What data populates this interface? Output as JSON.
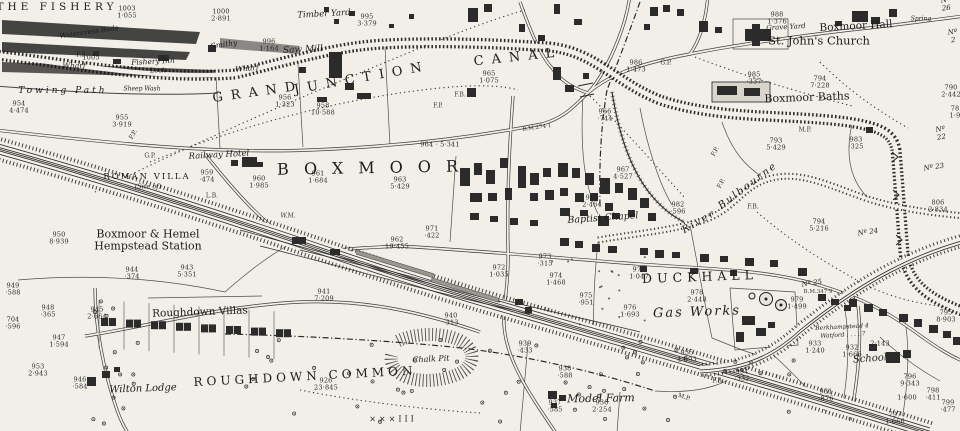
{
  "map": {
    "region_name": "Boxmoor and Roughdown Common (historic Ordnance Survey style plan)",
    "paper_color": "#f2efe8",
    "ink_color": "#1c1c1c",
    "labels": [
      {
        "id": "label-the-fishery",
        "t": "THE FISHERY",
        "x": 57,
        "y": 8,
        "fs": 10.5,
        "ls": 4,
        "cls": "big"
      },
      {
        "id": "label-grand",
        "t": "GRAND",
        "x": 258,
        "y": 93,
        "fs": 13,
        "ls": 8,
        "rot": -8,
        "cls": "big"
      },
      {
        "id": "label-junction",
        "t": "JUNCTION",
        "x": 362,
        "y": 79,
        "fs": 13,
        "ls": 8,
        "rot": -10,
        "cls": "big"
      },
      {
        "id": "label-canal",
        "t": "CANAL",
        "x": 518,
        "y": 58,
        "fs": 13,
        "ls": 8,
        "rot": -6,
        "cls": "big"
      },
      {
        "id": "label-boxmoor",
        "t": "BOXMOOR",
        "x": 375,
        "y": 168,
        "fs": 16,
        "ls": 15,
        "rot": -1,
        "cls": "big"
      },
      {
        "id": "label-roughdown-common",
        "t": "ROUGHDOWN COMMON",
        "x": 305,
        "y": 377,
        "fs": 12,
        "ls": 4,
        "rot": -3,
        "cls": "big"
      },
      {
        "id": "label-duckhall",
        "t": "DUCKHALL",
        "x": 700,
        "y": 277,
        "fs": 12.5,
        "ls": 5,
        "rot": -2,
        "cls": "big"
      },
      {
        "id": "label-gas-works",
        "t": "Gas Works",
        "x": 697,
        "y": 313,
        "fs": 13,
        "ls": 2,
        "rot": -2,
        "cls": "it"
      },
      {
        "id": "label-station",
        "t": "Boxmoor & Hemel\nHempstead Station",
        "x": 148,
        "y": 241,
        "fs": 11
      },
      {
        "id": "label-roughdown-villas",
        "t": "Roughdown Villas",
        "x": 200,
        "y": 313,
        "fs": 10.5,
        "rot": -2
      },
      {
        "id": "label-wilton-lodge",
        "t": "Wilton Lodge",
        "x": 143,
        "y": 389,
        "fs": 10,
        "rot": -2,
        "cls": "it"
      },
      {
        "id": "label-chalk-pit",
        "t": "Chalk Pit",
        "x": 431,
        "y": 360,
        "fs": 8,
        "rot": -3,
        "cls": "it"
      },
      {
        "id": "label-model-farm",
        "t": "Model Farm",
        "x": 601,
        "y": 399,
        "fs": 11,
        "rot": -1,
        "cls": "it"
      },
      {
        "id": "label-st-johns-church",
        "t": "St. John's Church",
        "x": 819,
        "y": 41,
        "fs": 11.5
      },
      {
        "id": "label-boxmoor-hall",
        "t": "Boxmoor Hall",
        "x": 856,
        "y": 27,
        "fs": 10.5,
        "rot": -3
      },
      {
        "id": "label-grave-yard",
        "t": "Grave Yard",
        "x": 786,
        "y": 28,
        "fs": 7,
        "rot": -3,
        "cls": "it"
      },
      {
        "id": "label-boxmoor-baths",
        "t": "Boxmoor Baths",
        "x": 807,
        "y": 98,
        "fs": 11,
        "rot": -2
      },
      {
        "id": "label-railway-hotel",
        "t": "Railway Hotel",
        "x": 219,
        "y": 156,
        "fs": 8.5,
        "rot": -3,
        "cls": "it"
      },
      {
        "id": "label-roman-villa",
        "t": "ROMAN VILLA",
        "x": 147,
        "y": 178,
        "fs": 8.5,
        "ls": 2,
        "cls": "big"
      },
      {
        "id": "label-roman-villa-site",
        "t": "(Site of)",
        "x": 148,
        "y": 187,
        "fs": 6.5,
        "cls": "it"
      },
      {
        "id": "label-baptist-chapel",
        "t": "Baptist Chapel",
        "x": 603,
        "y": 219,
        "fs": 9.5,
        "rot": -4,
        "cls": "it"
      },
      {
        "id": "label-river",
        "t": "River",
        "x": 699,
        "y": 222,
        "fs": 10,
        "ls": 2,
        "rot": -30,
        "cls": "it"
      },
      {
        "id": "label-bulbourne",
        "t": "Bulbourne",
        "x": 748,
        "y": 186,
        "fs": 10,
        "ls": 2,
        "rot": -37,
        "cls": "it"
      },
      {
        "id": "label-towing-path",
        "t": "Towing Path",
        "x": 63,
        "y": 91,
        "fs": 9,
        "ls": 3,
        "cls": "it"
      },
      {
        "id": "label-wharf-1",
        "t": "Wharf",
        "x": 74,
        "y": 66,
        "fs": 7.5,
        "cls": "it"
      },
      {
        "id": "label-wharf-2",
        "t": "Wharf",
        "x": 247,
        "y": 69,
        "fs": 7.5,
        "rot": -5,
        "cls": "it"
      },
      {
        "id": "label-saw-mill",
        "t": "Saw Mill",
        "x": 303,
        "y": 50,
        "fs": 9,
        "rot": -3,
        "cls": "it"
      },
      {
        "id": "label-timber-yard",
        "t": "Timber Yard",
        "x": 324,
        "y": 15,
        "fs": 8.5,
        "rot": -3,
        "cls": "it"
      },
      {
        "id": "label-smithy",
        "t": "Smithy",
        "x": 224,
        "y": 45,
        "fs": 7.5,
        "rot": -8,
        "cls": "it"
      },
      {
        "id": "label-fishery-inn",
        "t": "Fishery Inn",
        "x": 153,
        "y": 62,
        "fs": 7.5,
        "rot": -3,
        "cls": "it"
      },
      {
        "id": "label-lock",
        "t": "Lock",
        "x": 158,
        "y": 71,
        "fs": 6.5,
        "cls": "it"
      },
      {
        "id": "label-watercress-beds",
        "t": "Watercress Beds",
        "x": 89,
        "y": 33,
        "fs": 7,
        "rot": -8,
        "cls": "it"
      },
      {
        "id": "label-sheep-wash",
        "t": "Sheep Wash",
        "x": 142,
        "y": 90,
        "fs": 6,
        "cls": "it"
      },
      {
        "id": "label-school",
        "t": "School",
        "x": 870,
        "y": 359,
        "fs": 10,
        "rot": -4,
        "cls": "it"
      },
      {
        "id": "label-spring",
        "t": "Spring",
        "x": 921,
        "y": 20,
        "fs": 6,
        "cls": "it"
      },
      {
        "id": "label-berkhamsted",
        "t": "Berkhampstead 4",
        "x": 842,
        "y": 328,
        "fs": 6,
        "rot": -3,
        "cls": "it"
      },
      {
        "id": "label-watford",
        "t": "Watford . . . . 7",
        "x": 843,
        "y": 336,
        "fs": 6,
        "rot": -3,
        "cls": "it"
      },
      {
        "id": "label-xxx-marks",
        "t": "×××III",
        "x": 393,
        "y": 420,
        "fs": 8,
        "ls": 3
      },
      {
        "id": "label-wm",
        "t": "W.M.",
        "x": 288,
        "y": 217,
        "fs": 6,
        "cls": "abbr it"
      },
      {
        "id": "label-lb",
        "t": "L.B.",
        "x": 212,
        "y": 197,
        "fs": 6,
        "cls": "abbr"
      },
      {
        "id": "label-gp-1",
        "t": "G.P.",
        "x": 150,
        "y": 157,
        "fs": 6,
        "cls": "abbr"
      },
      {
        "id": "label-gp-2",
        "t": "G.P.",
        "x": 666,
        "y": 64,
        "fs": 6,
        "cls": "abbr"
      },
      {
        "id": "label-fp-1",
        "t": "F.P.",
        "x": 438,
        "y": 107,
        "fs": 6,
        "cls": "abbr"
      },
      {
        "id": "label-fp-2",
        "t": "F.P.",
        "x": 716,
        "y": 152,
        "fs": 6,
        "rot": -60,
        "cls": "abbr"
      },
      {
        "id": "label-fp-3",
        "t": "F.P.",
        "x": 722,
        "y": 184,
        "fs": 6,
        "rot": -60,
        "cls": "abbr"
      },
      {
        "id": "label-fp-4",
        "t": "F.P.",
        "x": 134,
        "y": 135,
        "fs": 6,
        "rot": -60,
        "cls": "abbr"
      },
      {
        "id": "label-fb-1",
        "t": "F.B.",
        "x": 82,
        "y": 56,
        "fs": 6,
        "cls": "abbr"
      },
      {
        "id": "label-fb-2",
        "t": "F.B.",
        "x": 460,
        "y": 96,
        "fs": 6,
        "cls": "abbr"
      },
      {
        "id": "label-fb-3",
        "t": "F.B.",
        "x": 753,
        "y": 208,
        "fs": 6,
        "cls": "abbr"
      },
      {
        "id": "label-fb-4",
        "t": "F.B.",
        "x": 718,
        "y": 382,
        "fs": 6,
        "cls": "abbr"
      },
      {
        "id": "label-mp-1",
        "t": "M.P.",
        "x": 805,
        "y": 131,
        "fs": 6,
        "cls": "abbr"
      },
      {
        "id": "label-mp-2",
        "t": "M.P.",
        "x": 684,
        "y": 398,
        "fs": 6,
        "rot": 17,
        "cls": "abbr"
      },
      {
        "id": "label-bm-1",
        "t": "B.M.274·1",
        "x": 537,
        "y": 128,
        "fs": 5.5,
        "rot": -8,
        "cls": "abbr"
      },
      {
        "id": "label-bm-2",
        "t": "B.M.347·9",
        "x": 818,
        "y": 292,
        "fs": 5.5,
        "cls": "abbr"
      },
      {
        "id": "label-lock-no26",
        "t": "Nº 26",
        "x": 946,
        "y": 5,
        "fs": 7,
        "rot": -6,
        "cls": "it"
      },
      {
        "id": "label-lock-no21",
        "t": "Nº 2",
        "x": 953,
        "y": 37,
        "fs": 7,
        "rot": -6,
        "cls": "it"
      },
      {
        "id": "label-lock-no22",
        "t": "Nº 22",
        "x": 941,
        "y": 134,
        "fs": 7,
        "rot": -8,
        "cls": "it"
      },
      {
        "id": "label-lock-no23",
        "t": "Nº 23",
        "x": 934,
        "y": 168,
        "fs": 7,
        "rot": -8,
        "cls": "it"
      },
      {
        "id": "label-lock-no24",
        "t": "Nº 24",
        "x": 868,
        "y": 233,
        "fs": 7,
        "rot": -8,
        "cls": "it"
      },
      {
        "id": "label-lock-no25",
        "t": "Nº 25",
        "x": 812,
        "y": 284,
        "fs": 7,
        "rot": -8,
        "cls": "it"
      },
      {
        "id": "parcel-1003",
        "t": "1003\n1·055",
        "x": 127,
        "y": 13,
        "cls": "parcel"
      },
      {
        "id": "parcel-1000",
        "t": "1000\n2·891",
        "x": 221,
        "y": 16,
        "cls": "parcel"
      },
      {
        "id": "parcel-1005",
        "t": "1005",
        "x": 91,
        "y": 58,
        "cls": "parcel"
      },
      {
        "id": "parcel-996",
        "t": "996\n1·164",
        "x": 269,
        "y": 46,
        "cls": "parcel"
      },
      {
        "id": "parcel-995",
        "t": "995\n3·379",
        "x": 367,
        "y": 21,
        "cls": "parcel"
      },
      {
        "id": "parcel-955",
        "t": "955\n3·919",
        "x": 122,
        "y": 122,
        "cls": "parcel"
      },
      {
        "id": "parcel-954",
        "t": "954\n4·474",
        "x": 19,
        "y": 108,
        "cls": "parcel"
      },
      {
        "id": "parcel-956",
        "t": "956\n1·323",
        "x": 285,
        "y": 102,
        "cls": "parcel"
      },
      {
        "id": "parcel-958",
        "t": "958\n10·588",
        "x": 323,
        "y": 110,
        "cls": "parcel"
      },
      {
        "id": "parcel-964",
        "t": "964 · 5·341",
        "x": 440,
        "y": 145,
        "cls": "parcel"
      },
      {
        "id": "parcel-959",
        "t": "959\n·474",
        "x": 207,
        "y": 177,
        "cls": "parcel"
      },
      {
        "id": "parcel-960",
        "t": "960\n1·985",
        "x": 259,
        "y": 183,
        "cls": "parcel"
      },
      {
        "id": "parcel-961",
        "t": "961\n1·684",
        "x": 318,
        "y": 178,
        "cls": "parcel"
      },
      {
        "id": "parcel-963",
        "t": "963\n5·429",
        "x": 400,
        "y": 184,
        "cls": "parcel"
      },
      {
        "id": "parcel-962",
        "t": "962\n19·455",
        "x": 397,
        "y": 244,
        "cls": "parcel"
      },
      {
        "id": "parcel-971",
        "t": "971\n·422",
        "x": 432,
        "y": 233,
        "cls": "parcel"
      },
      {
        "id": "parcel-972",
        "t": "972\n1·035",
        "x": 499,
        "y": 272,
        "cls": "parcel"
      },
      {
        "id": "parcel-973",
        "t": "973\n·315",
        "x": 545,
        "y": 261,
        "cls": "parcel"
      },
      {
        "id": "parcel-974",
        "t": "974\n1·468",
        "x": 556,
        "y": 280,
        "cls": "parcel"
      },
      {
        "id": "parcel-975",
        "t": "975\n·951",
        "x": 586,
        "y": 300,
        "cls": "parcel"
      },
      {
        "id": "parcel-976",
        "t": "976\n1·693",
        "x": 630,
        "y": 312,
        "cls": "parcel"
      },
      {
        "id": "parcel-977",
        "t": "977\n1·047",
        "x": 639,
        "y": 274,
        "cls": "parcel"
      },
      {
        "id": "parcel-978",
        "t": "978\n2·448",
        "x": 697,
        "y": 297,
        "cls": "parcel"
      },
      {
        "id": "parcel-979",
        "t": "979\n1·499",
        "x": 797,
        "y": 304,
        "cls": "parcel"
      },
      {
        "id": "parcel-982",
        "t": "982\n·596",
        "x": 678,
        "y": 209,
        "cls": "parcel"
      },
      {
        "id": "parcel-967",
        "t": "967\n4·527",
        "x": 623,
        "y": 174,
        "cls": "parcel"
      },
      {
        "id": "parcel-968",
        "t": "968\n2·464",
        "x": 592,
        "y": 202,
        "cls": "parcel"
      },
      {
        "id": "parcel-983",
        "t": "983\n·325",
        "x": 856,
        "y": 144,
        "cls": "parcel"
      },
      {
        "id": "parcel-793",
        "t": "793\n5·429",
        "x": 776,
        "y": 145,
        "cls": "parcel"
      },
      {
        "id": "parcel-794a",
        "t": "794\n7·228",
        "x": 820,
        "y": 83,
        "cls": "parcel"
      },
      {
        "id": "parcel-794b",
        "t": "794\n5·216",
        "x": 819,
        "y": 226,
        "cls": "parcel"
      },
      {
        "id": "parcel-795",
        "t": "795\n8·903",
        "x": 946,
        "y": 317,
        "cls": "parcel"
      },
      {
        "id": "parcel-796",
        "t": "796\n9·343",
        "x": 910,
        "y": 381,
        "cls": "parcel"
      },
      {
        "id": "parcel-1600",
        "t": "1·600",
        "x": 907,
        "y": 398,
        "cls": "parcel"
      },
      {
        "id": "parcel-798",
        "t": "798\n·411",
        "x": 933,
        "y": 395,
        "cls": "parcel"
      },
      {
        "id": "parcel-799",
        "t": "799\n·477",
        "x": 948,
        "y": 407,
        "cls": "parcel"
      },
      {
        "id": "parcel-797",
        "t": "797\n1·666",
        "x": 895,
        "y": 419,
        "cls": "parcel"
      },
      {
        "id": "parcel-790",
        "t": "790\n2·442",
        "x": 951,
        "y": 92,
        "cls": "parcel"
      },
      {
        "id": "parcel-78x",
        "t": "78\n1·9",
        "x": 955,
        "y": 113,
        "cls": "parcel"
      },
      {
        "id": "parcel-806",
        "t": "806\n2·834",
        "x": 938,
        "y": 207,
        "cls": "parcel"
      },
      {
        "id": "parcel-935",
        "t": "935\n4·693",
        "x": 687,
        "y": 357,
        "cls": "parcel"
      },
      {
        "id": "parcel-934",
        "t": "934\n·332",
        "x": 742,
        "y": 376,
        "cls": "parcel"
      },
      {
        "id": "parcel-933",
        "t": "933\n1·240",
        "x": 815,
        "y": 348,
        "cls": "parcel"
      },
      {
        "id": "parcel-932",
        "t": "932\n1·666",
        "x": 852,
        "y": 352,
        "cls": "parcel"
      },
      {
        "id": "parcel-2143",
        "t": "2·143",
        "x": 880,
        "y": 344,
        "cls": "parcel"
      },
      {
        "id": "parcel-931",
        "t": "931\n·876",
        "x": 826,
        "y": 396,
        "cls": "parcel"
      },
      {
        "id": "parcel-938",
        "t": "938\n·588",
        "x": 565,
        "y": 373,
        "cls": "parcel"
      },
      {
        "id": "parcel-937",
        "t": "937\n·585",
        "x": 555,
        "y": 407,
        "cls": "parcel"
      },
      {
        "id": "parcel-936",
        "t": "936\n2·254",
        "x": 602,
        "y": 407,
        "cls": "parcel"
      },
      {
        "id": "parcel-939",
        "t": "939\n·433",
        "x": 525,
        "y": 348,
        "cls": "parcel"
      },
      {
        "id": "parcel-926",
        "t": "926\n23·845",
        "x": 326,
        "y": 385,
        "cls": "parcel"
      },
      {
        "id": "parcel-941",
        "t": "941\n7·209",
        "x": 324,
        "y": 296,
        "cls": "parcel"
      },
      {
        "id": "parcel-943",
        "t": "943\n5·351",
        "x": 187,
        "y": 272,
        "cls": "parcel"
      },
      {
        "id": "parcel-944",
        "t": "944\n·374",
        "x": 132,
        "y": 274,
        "cls": "parcel"
      },
      {
        "id": "parcel-945",
        "t": "945\n2·664",
        "x": 97,
        "y": 314,
        "cls": "parcel"
      },
      {
        "id": "parcel-946",
        "t": "946\n·584",
        "x": 80,
        "y": 384,
        "cls": "parcel"
      },
      {
        "id": "parcel-947",
        "t": "947\n1·594",
        "x": 59,
        "y": 342,
        "cls": "parcel"
      },
      {
        "id": "parcel-948",
        "t": "948\n·365",
        "x": 48,
        "y": 312,
        "cls": "parcel"
      },
      {
        "id": "parcel-704",
        "t": "704\n·596",
        "x": 13,
        "y": 324,
        "cls": "parcel"
      },
      {
        "id": "parcel-953",
        "t": "953\n2·943",
        "x": 38,
        "y": 371,
        "cls": "parcel"
      },
      {
        "id": "parcel-949",
        "t": "949\n·588",
        "x": 13,
        "y": 290,
        "cls": "parcel"
      },
      {
        "id": "parcel-950",
        "t": "950\n8·939",
        "x": 59,
        "y": 239,
        "cls": "parcel"
      },
      {
        "id": "parcel-940",
        "t": "940\n·313",
        "x": 451,
        "y": 320,
        "cls": "parcel"
      },
      {
        "id": "parcel-985",
        "t": "985\n·337",
        "x": 754,
        "y": 79,
        "cls": "parcel"
      },
      {
        "id": "parcel-988",
        "t": "988\n1·376",
        "x": 777,
        "y": 19,
        "cls": "parcel"
      },
      {
        "id": "parcel-986",
        "t": "986\n1·473",
        "x": 636,
        "y": 67,
        "cls": "parcel"
      },
      {
        "id": "parcel-966",
        "t": "966\n·744",
        "x": 605,
        "y": 116,
        "cls": "parcel"
      },
      {
        "id": "parcel-965",
        "t": "965\n1·075",
        "x": 489,
        "y": 78,
        "cls": "parcel"
      }
    ]
  }
}
